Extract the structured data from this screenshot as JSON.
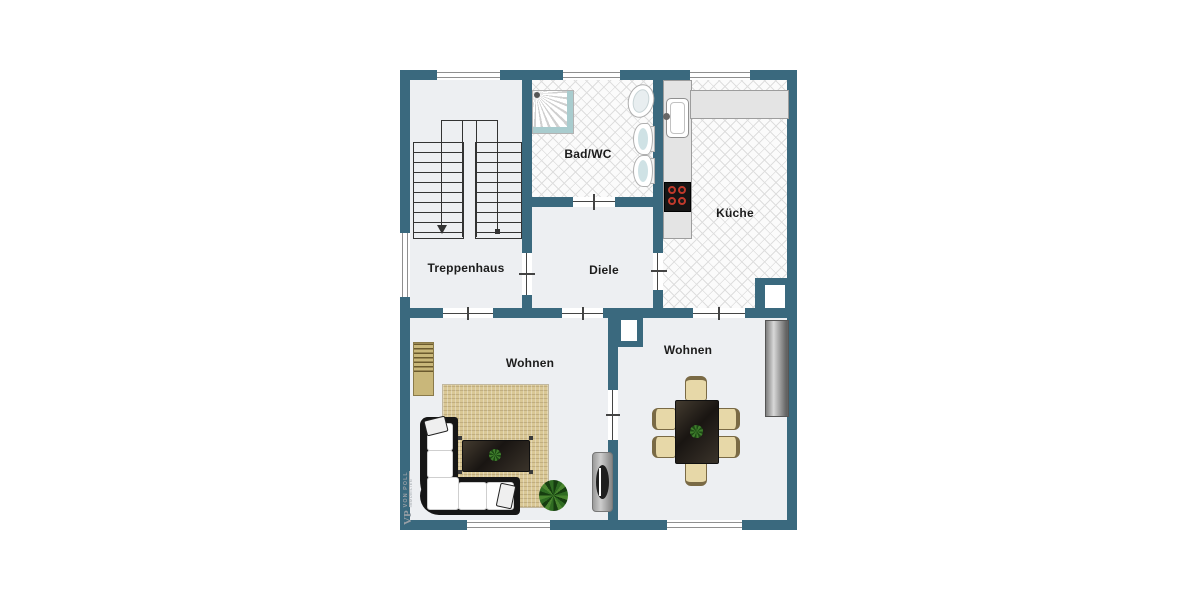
{
  "rooms": {
    "treppenhaus": {
      "label": "Treppenhaus"
    },
    "bad": {
      "label": "Bad/WC"
    },
    "kueche": {
      "label": "Küche"
    },
    "diele": {
      "label": "Diele"
    },
    "wohnen_left": {
      "label": "Wohnen"
    },
    "wohnen_right": {
      "label": "Wohnen"
    }
  },
  "watermark": {
    "initials": "VP",
    "name": "VON POLL",
    "subtitle": "IMMOBILIEN"
  },
  "colors": {
    "wall": "#3a697e",
    "floor": "#edeff2",
    "tile_bg": "#fbfbfb",
    "tile_line": "#dedede",
    "counter": "#e4e4e4",
    "rug": "#d9c795",
    "sofa": "#161616",
    "cushion": "#ffffff",
    "chair": "#e7d8a8",
    "chair_edge": "#7a6a45",
    "burner_ring": "#c0392b",
    "door_line": "#444444",
    "label": "#1c1c1c",
    "watermark": "#9aa0a6"
  }
}
